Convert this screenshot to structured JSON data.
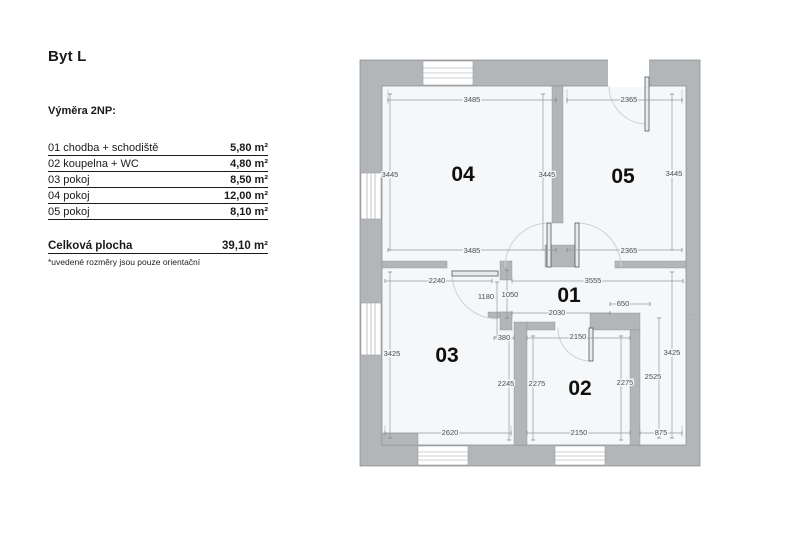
{
  "left_panel": {
    "title": "Byt L",
    "subtitle": "Výměra 2NP:",
    "rows": [
      {
        "label": "01 chodba + schodiště",
        "value": "5,80 m²"
      },
      {
        "label": "02 koupelna + WC",
        "value": "4,80 m²"
      },
      {
        "label": "03 pokoj",
        "value": "8,50 m²"
      },
      {
        "label": "04 pokoj",
        "value": "12,00 m²"
      },
      {
        "label": "05 pokoj",
        "value": "8,10 m²"
      }
    ],
    "total": {
      "label": "Celková plocha",
      "value": "39,10 m²"
    },
    "footnote": "*uvedené rozměry jsou pouze orientační"
  },
  "plan": {
    "rooms": {
      "r01": "01",
      "r02": "02",
      "r03": "03",
      "r04": "04",
      "r05": "05"
    },
    "dims": {
      "top04": "3485",
      "top05": "2365",
      "left04": "3445",
      "mid04": "3445",
      "right05": "3445",
      "bot04": "3485",
      "bot05": "2365",
      "w2240": "2240",
      "w3555": "3555",
      "h1180": "1180",
      "h1050": "1050",
      "w650": "650",
      "w2030": "2030",
      "w380": "380",
      "w2150door": "2150",
      "h3425l": "3425",
      "h3425r": "3425",
      "h2525": "2525",
      "h2245": "2245",
      "h2275l": "2275",
      "h2275r": "2275",
      "bot03": "2620",
      "bot02": "2150",
      "bot875": "875"
    },
    "colors": {
      "wall": "#b3b6b9",
      "floor": "#f5f7f9",
      "dim_line": "#97999c",
      "dim_text": "#4b4e52",
      "room_label": "#0f0f0f"
    }
  }
}
